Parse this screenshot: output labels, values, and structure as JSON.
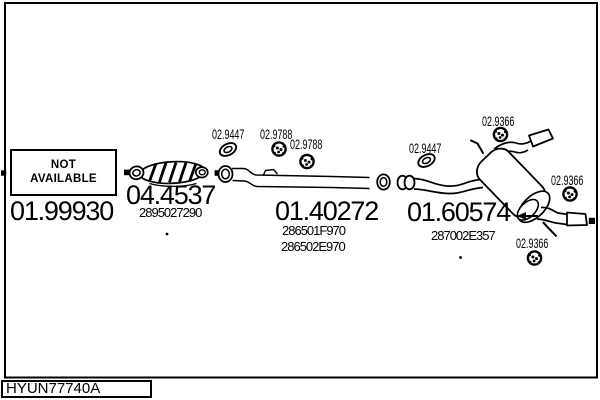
{
  "colors": {
    "background": "#ffffff",
    "ink": "#000000"
  },
  "footer": {
    "diagram_code": "HYUN77740A"
  },
  "placeholder_box": {
    "line1": "NOT",
    "line2": "AVAILABLE"
  },
  "sections": {
    "front_pipe": {
      "code": "01.99930"
    },
    "catalytic_converter": {
      "code": "04.4537",
      "oem_number": "2895027290"
    },
    "centre_pipe": {
      "code": "01.40272",
      "oem_numbers": [
        "286501F970",
        "286502E970"
      ]
    },
    "rear_silencer": {
      "code": "01.60574",
      "oem_number": "287002E357"
    }
  },
  "fittings": {
    "gasket_centre": {
      "code": "02.9447"
    },
    "mount_centre_upper": {
      "code": "02.9788"
    },
    "mount_centre_lower": {
      "code": "02.9788"
    },
    "gasket_rear": {
      "code": "02.9447"
    },
    "mount_rear_top": {
      "code": "02.9366"
    },
    "mount_rear_right": {
      "code": "02.9366"
    },
    "mount_rear_bottom": {
      "code": "02.9366"
    }
  },
  "drawings": [
    "diagram-frame",
    "catalytic-converter-drawing",
    "centre-pipe-drawing",
    "rear-silencer-drawing",
    "gasket-icon",
    "rubber-mount-icon",
    "connector-square-icon"
  ]
}
